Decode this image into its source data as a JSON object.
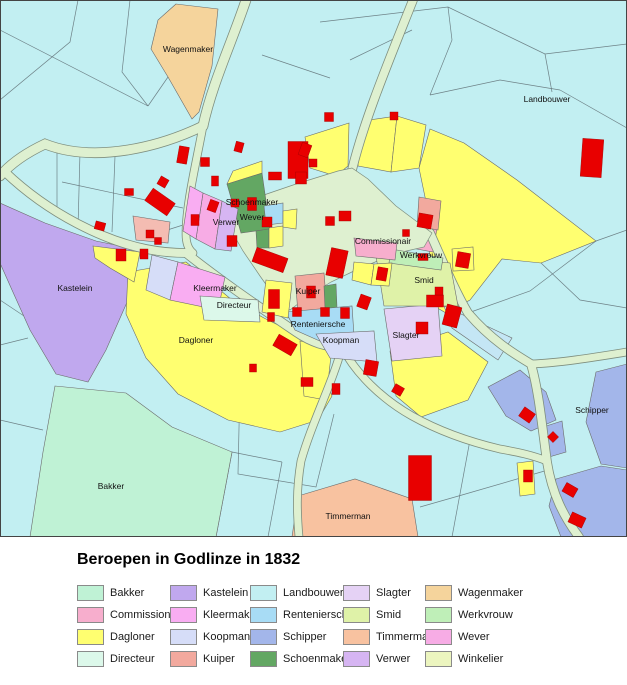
{
  "legend": {
    "title": "Beroepen in Godlinze in 1832",
    "items": [
      {
        "label": "Bakker",
        "color": "#BFF2D5"
      },
      {
        "label": "Commissionair",
        "color": "#F7AECD"
      },
      {
        "label": "Dagloner",
        "color": "#FFFF70"
      },
      {
        "label": "Directeur",
        "color": "#DCF8EA"
      },
      {
        "label": "Kastelein",
        "color": "#C0A8EE"
      },
      {
        "label": "Kleermaker",
        "color": "#F9ADF2"
      },
      {
        "label": "Koopman",
        "color": "#D6DDF8"
      },
      {
        "label": "Kuiper",
        "color": "#F2A99E"
      },
      {
        "label": "Landbouwer",
        "color": "#C2EFF2"
      },
      {
        "label": "Renteniersche",
        "color": "#A8DCF5"
      },
      {
        "label": "Schipper",
        "color": "#A3B6EA"
      },
      {
        "label": "Schoenmaker",
        "color": "#63A763"
      },
      {
        "label": "Slagter",
        "color": "#E5D2F5"
      },
      {
        "label": "Smid",
        "color": "#DFF2A8"
      },
      {
        "label": "Timmerman",
        "color": "#F8C2A0"
      },
      {
        "label": "Verwer",
        "color": "#D6B5F2"
      },
      {
        "label": "Wagenmaker",
        "color": "#F5D49C"
      },
      {
        "label": "Werkvrouw",
        "color": "#BFEFB8"
      },
      {
        "label": "Wever",
        "color": "#F7ACE5"
      },
      {
        "label": "Winkelier",
        "color": "#ECF5BF"
      }
    ],
    "layout": {
      "col_x": [
        77,
        170,
        250,
        343,
        425
      ],
      "row_y": [
        48,
        70,
        92,
        114
      ],
      "rows_per_col": 4
    }
  },
  "map": {
    "width": 627,
    "height": 537,
    "background_color": "#C2EFF2",
    "road_color": "#DEF0D0",
    "road_casing_color": "#7E8E7E",
    "parcel_line_color": "#6A6A6A",
    "field_line_color": "#5F6F74",
    "building_color": "#E80000",
    "building_edge_color": "#A00000",
    "border_color": "#444444",
    "label_color": "#111111",
    "labels": [
      {
        "text": "Wagenmaker",
        "x": 188,
        "y": 52
      },
      {
        "text": "Landbouwer",
        "x": 547,
        "y": 102
      },
      {
        "text": "Schoenmaker",
        "x": 252,
        "y": 205
      },
      {
        "text": "Verwer",
        "x": 226,
        "y": 225
      },
      {
        "text": "Wever",
        "x": 252,
        "y": 220
      },
      {
        "text": "Commissionair",
        "x": 383,
        "y": 244
      },
      {
        "text": "Werkvrouw",
        "x": 421,
        "y": 258
      },
      {
        "text": "Smid",
        "x": 424,
        "y": 283
      },
      {
        "text": "Kleermaker",
        "x": 215,
        "y": 291
      },
      {
        "text": "Directeur",
        "x": 234,
        "y": 308
      },
      {
        "text": "Kuiper",
        "x": 308,
        "y": 294
      },
      {
        "text": "Renteniersche",
        "x": 318,
        "y": 327
      },
      {
        "text": "Koopman",
        "x": 341,
        "y": 343
      },
      {
        "text": "Slagter",
        "x": 406,
        "y": 338
      },
      {
        "text": "Dagloner",
        "x": 196,
        "y": 343
      },
      {
        "text": "Kastelein",
        "x": 75,
        "y": 291
      },
      {
        "text": "Bakker",
        "x": 111,
        "y": 489
      },
      {
        "text": "Timmerman",
        "x": 348,
        "y": 519
      },
      {
        "text": "Schipper",
        "x": 592,
        "y": 413
      }
    ],
    "field_lines": [
      "M0,30 L148,106",
      "M78,0 L70,42 L0,100",
      "M130,0 L122,72 L148,106",
      "M148,106 L168,77",
      "M320,22 L448,7 L545,54 L627,44",
      "M448,7 L452,40 L430,95",
      "M545,54 L552,92",
      "M430,95 L500,80 L560,90",
      "M560,90 L627,128",
      "M262,55 L330,78",
      "M350,60 L412,30",
      "M57,146 L57,216",
      "M80,152 L78,228",
      "M115,156 L112,232",
      "M62,182 L183,208",
      "M136,240 L183,225",
      "M0,300 L30,320",
      "M0,345 L28,338",
      "M0,420 L43,430",
      "M43,452 L150,468",
      "M128,396 L108,537",
      "M172,427 L152,537",
      "M232,452 L216,537",
      "M282,462 L268,537",
      "M232,452 L282,462",
      "M240,382 L238,474 L316,487 L334,414",
      "M468,313 L530,291 L596,241",
      "M548,470 L462,495 L420,507",
      "M470,440 L452,537",
      "M596,241 L627,230",
      "M541,263 L580,300 L627,308"
    ],
    "roads": [
      {
        "d": "M246,0 C232,42 212,84 203,126",
        "w": 9
      },
      {
        "d": "M203,126 C162,146 96,164 45,144 C28,152 12,162 0,176",
        "w": 9
      },
      {
        "d": "M203,126 C196,164 186,204 186,234 C186,243 188,249 193,253",
        "w": 7
      },
      {
        "d": "M5,172 C50,215 106,241 146,249 C161,252 174,253 186,253",
        "w": 8
      },
      {
        "d": "M186,253 C216,277 252,302 296,332 C312,343 326,347 342,347",
        "w": 8
      },
      {
        "d": "M352,170 C364,120 390,58 413,0",
        "w": 8
      },
      {
        "d": "M430,233 C443,262 455,291 468,313 C492,341 516,355 531,364 C539,392 542,426 547,462 C552,494 564,517 579,537",
        "w": 8
      },
      {
        "d": "M531,364 C560,363 596,357 627,352",
        "w": 7
      },
      {
        "d": "M342,347 C356,374 382,399 412,416 C437,430 466,441 500,449 C517,452 532,455 547,461",
        "w": 7
      },
      {
        "d": "M342,347 C333,382 312,422 301,461 C296,490 297,514 299,537",
        "w": 7
      }
    ],
    "green_area": "228,216 258,197 296,184 338,171 352,168 368,179 396,206 420,224 432,233 424,247 402,252 380,260 356,270 331,282 307,297 290,310 277,300 260,276 243,251 232,232",
    "parcels": [
      {
        "layer": 0,
        "profession": "Wagenmaker",
        "pts": "176,4 218,9 212,66 199,112 192,119 168,77 151,49 158,20"
      },
      {
        "layer": 0,
        "profession": "Dagloner",
        "pts": "430,129 464,143 517,180 596,241 541,263 502,259 470,300 446,313 427,302 431,226 419,168"
      },
      {
        "layer": 0,
        "profession": "Kastelein",
        "pts": "0,203 45,223 96,241 140,250 128,300 106,350 88,382 56,374 30,330 12,290 0,263"
      },
      {
        "layer": 0,
        "profession": "Bakker",
        "pts": "55,386 126,393 172,427 232,452 216,537 30,537 43,452"
      },
      {
        "layer": 0,
        "profession": "Dagloner",
        "pts": "128,272 186,262 232,300 264,318 300,336 320,362 332,396 318,420 280,432 228,420 178,394 146,358 126,314"
      },
      {
        "layer": 0,
        "profession": "Dagloner",
        "pts": "93,246 140,252 134,282 110,268 95,258"
      },
      {
        "layer": 0,
        "color": "#F4BCB2",
        "pts": "133,216 170,222 168,243 136,240"
      },
      {
        "layer": 0,
        "profession": "Timmerman",
        "pts": "298,496 355,479 412,499 418,537 292,537"
      },
      {
        "layer": 0,
        "profession": "Schipper",
        "pts": "596,372 627,364 627,468 601,464 586,422"
      },
      {
        "layer": 0,
        "profession": "Schipper",
        "pts": "488,387 520,370 546,392 556,420 531,431 506,416"
      },
      {
        "layer": 0,
        "profession": "Schipper",
        "pts": "556,479 601,466 627,470 627,537 561,537 549,506"
      },
      {
        "layer": 0,
        "profession": "Schipper",
        "pts": "543,427 562,421 566,452 549,457"
      },
      {
        "layer": 0,
        "profession": "Dagloner",
        "pts": "517,463 533,461 535,494 520,496"
      },
      {
        "layer": 0,
        "profession": "Dagloner",
        "pts": "390,351 448,332 488,362 468,400 421,417 396,396"
      },
      {
        "layer": 0,
        "profession": "Dagloner",
        "pts": "300,341 332,347 326,400 304,396"
      },
      {
        "layer": 0,
        "color": "#C4E6F5",
        "pts": "444,306 512,338 498,360 452,328"
      },
      {
        "layer": 0,
        "profession": "Dagloner",
        "pts": "305,137 349,123 348,166 336,176 310,168"
      },
      {
        "layer": 0,
        "profession": "Dagloner",
        "pts": "358,166 362,121 397,116 391,172"
      },
      {
        "layer": 0,
        "profession": "Dagloner",
        "pts": "397,116 426,125 419,168 391,172"
      },
      {
        "layer": 0,
        "profession": "Commissionair",
        "pts": "404,222 437,228 433,252 406,247"
      },
      {
        "layer": 0,
        "profession": "Kuiper",
        "pts": "419,197 441,201 438,230 417,226"
      },
      {
        "layer": 1,
        "profession": "Schoenmaker",
        "pts": "227,184 262,173 270,229 241,233"
      },
      {
        "layer": 1,
        "profession": "Dagloner",
        "pts": "233,171 262,161 262,173 227,184"
      },
      {
        "layer": 1,
        "profession": "Wever",
        "pts": "203,193 222,201 215,249 196,239"
      },
      {
        "layer": 1,
        "profession": "Verwer",
        "pts": "222,201 238,209 231,251 215,249"
      },
      {
        "layer": 1,
        "profession": "Kleermaker",
        "pts": "190,186 203,193 196,239 183,231"
      },
      {
        "layer": 1,
        "profession": "Schoenmaker",
        "pts": "256,231 269,229 269,248 257,248"
      },
      {
        "layer": 1,
        "profession": "Dagloner",
        "pts": "269,228 283,226 283,246 269,248"
      },
      {
        "layer": 1,
        "profession": "Renteniersche",
        "pts": "264,206 283,203 283,223 266,225"
      },
      {
        "layer": 1,
        "profession": "Dagloner",
        "pts": "283,211 297,209 296,229 283,227"
      },
      {
        "layer": 1,
        "profession": "Koopman",
        "pts": "152,255 178,262 170,300 146,290"
      },
      {
        "layer": 1,
        "profession": "Kleermaker",
        "pts": "178,262 225,277 218,310 170,300"
      },
      {
        "layer": 1,
        "profession": "Directeur",
        "pts": "200,296 258,300 260,322 204,320"
      },
      {
        "layer": 1,
        "profession": "Kuiper",
        "pts": "295,276 324,273 327,310 298,313"
      },
      {
        "layer": 1,
        "profession": "Schoenmaker",
        "pts": "324,286 336,284 337,308 325,308"
      },
      {
        "layer": 1,
        "profession": "Renteniersche",
        "pts": "286,312 352,306 355,350 322,342 295,330"
      },
      {
        "layer": 1,
        "profession": "Koopman",
        "pts": "316,334 374,331 377,362 330,358"
      },
      {
        "layer": 1,
        "profession": "Slagter",
        "pts": "384,309 438,304 442,356 392,361"
      },
      {
        "layer": 1,
        "profession": "Smid",
        "pts": "376,256 450,263 458,306 384,306"
      },
      {
        "layer": 1,
        "profession": "Werkvrouw",
        "pts": "391,249 443,258 441,270 389,263"
      },
      {
        "layer": 1,
        "profession": "Commissionair",
        "pts": "354,238 397,243 395,260 356,256"
      },
      {
        "layer": 1,
        "profession": "Dagloner",
        "pts": "354,262 374,264 371,285 352,280"
      },
      {
        "layer": 1,
        "profession": "Dagloner",
        "pts": "374,264 392,263 389,286 371,285"
      },
      {
        "layer": 1,
        "profession": "Dagloner",
        "pts": "452,249 473,247 474,270 453,271"
      },
      {
        "layer": 1,
        "profession": "Dagloner",
        "pts": "266,280 292,283 288,318 262,312"
      }
    ],
    "buildings": [
      [
        298,
        160,
        20,
        37,
        0
      ],
      [
        592,
        158,
        21,
        38,
        4
      ],
      [
        329,
        117,
        9,
        9,
        0
      ],
      [
        394,
        116,
        8,
        8,
        0
      ],
      [
        305,
        150,
        10,
        13,
        20
      ],
      [
        313,
        163,
        8,
        8,
        0
      ],
      [
        160,
        202,
        27,
        15,
        35
      ],
      [
        183,
        155,
        10,
        17,
        10
      ],
      [
        163,
        182,
        9,
        9,
        30
      ],
      [
        205,
        162,
        9,
        9,
        0
      ],
      [
        215,
        181,
        7,
        10,
        0
      ],
      [
        239,
        147,
        8,
        10,
        15
      ],
      [
        195,
        220,
        8,
        11,
        0
      ],
      [
        213,
        206,
        9,
        11,
        20
      ],
      [
        235,
        203,
        8,
        8,
        0
      ],
      [
        252,
        204,
        9,
        13,
        0
      ],
      [
        232,
        241,
        10,
        11,
        0
      ],
      [
        267,
        222,
        10,
        10,
        0
      ],
      [
        275,
        176,
        13,
        8,
        0
      ],
      [
        301,
        178,
        11,
        12,
        0
      ],
      [
        270,
        260,
        33,
        15,
        20
      ],
      [
        337,
        263,
        17,
        28,
        12
      ],
      [
        345,
        216,
        12,
        10,
        0
      ],
      [
        330,
        221,
        9,
        9,
        0
      ],
      [
        425,
        221,
        14,
        14,
        10
      ],
      [
        406,
        233,
        7,
        7,
        0
      ],
      [
        423,
        257,
        10,
        7,
        0
      ],
      [
        463,
        260,
        13,
        15,
        10
      ],
      [
        435,
        301,
        17,
        12,
        0
      ],
      [
        439,
        291,
        8,
        8,
        0
      ],
      [
        452,
        316,
        15,
        21,
        15
      ],
      [
        422,
        328,
        12,
        12,
        0
      ],
      [
        398,
        390,
        10,
        9,
        30
      ],
      [
        371,
        368,
        13,
        15,
        10
      ],
      [
        364,
        302,
        11,
        13,
        20
      ],
      [
        382,
        274,
        10,
        13,
        10
      ],
      [
        311,
        292,
        9,
        12,
        0
      ],
      [
        297,
        312,
        9,
        9,
        0
      ],
      [
        325,
        312,
        9,
        9,
        0
      ],
      [
        345,
        313,
        9,
        11,
        0
      ],
      [
        274,
        299,
        11,
        19,
        0
      ],
      [
        271,
        317,
        7,
        9,
        0
      ],
      [
        285,
        345,
        21,
        13,
        30
      ],
      [
        253,
        368,
        7,
        8,
        0
      ],
      [
        307,
        382,
        12,
        9,
        0
      ],
      [
        336,
        389,
        8,
        11,
        0
      ],
      [
        129,
        192,
        9,
        7,
        0
      ],
      [
        100,
        226,
        10,
        8,
        15
      ],
      [
        150,
        234,
        8,
        8,
        0
      ],
      [
        158,
        241,
        7,
        7,
        0
      ],
      [
        121,
        255,
        10,
        12,
        0
      ],
      [
        144,
        254,
        8,
        10,
        0
      ],
      [
        420,
        478,
        23,
        45,
        0
      ],
      [
        527,
        415,
        13,
        11,
        35
      ],
      [
        553,
        437,
        8,
        8,
        45
      ],
      [
        528,
        476,
        9,
        12,
        0
      ],
      [
        570,
        490,
        13,
        10,
        30
      ],
      [
        577,
        520,
        15,
        11,
        25
      ]
    ]
  }
}
